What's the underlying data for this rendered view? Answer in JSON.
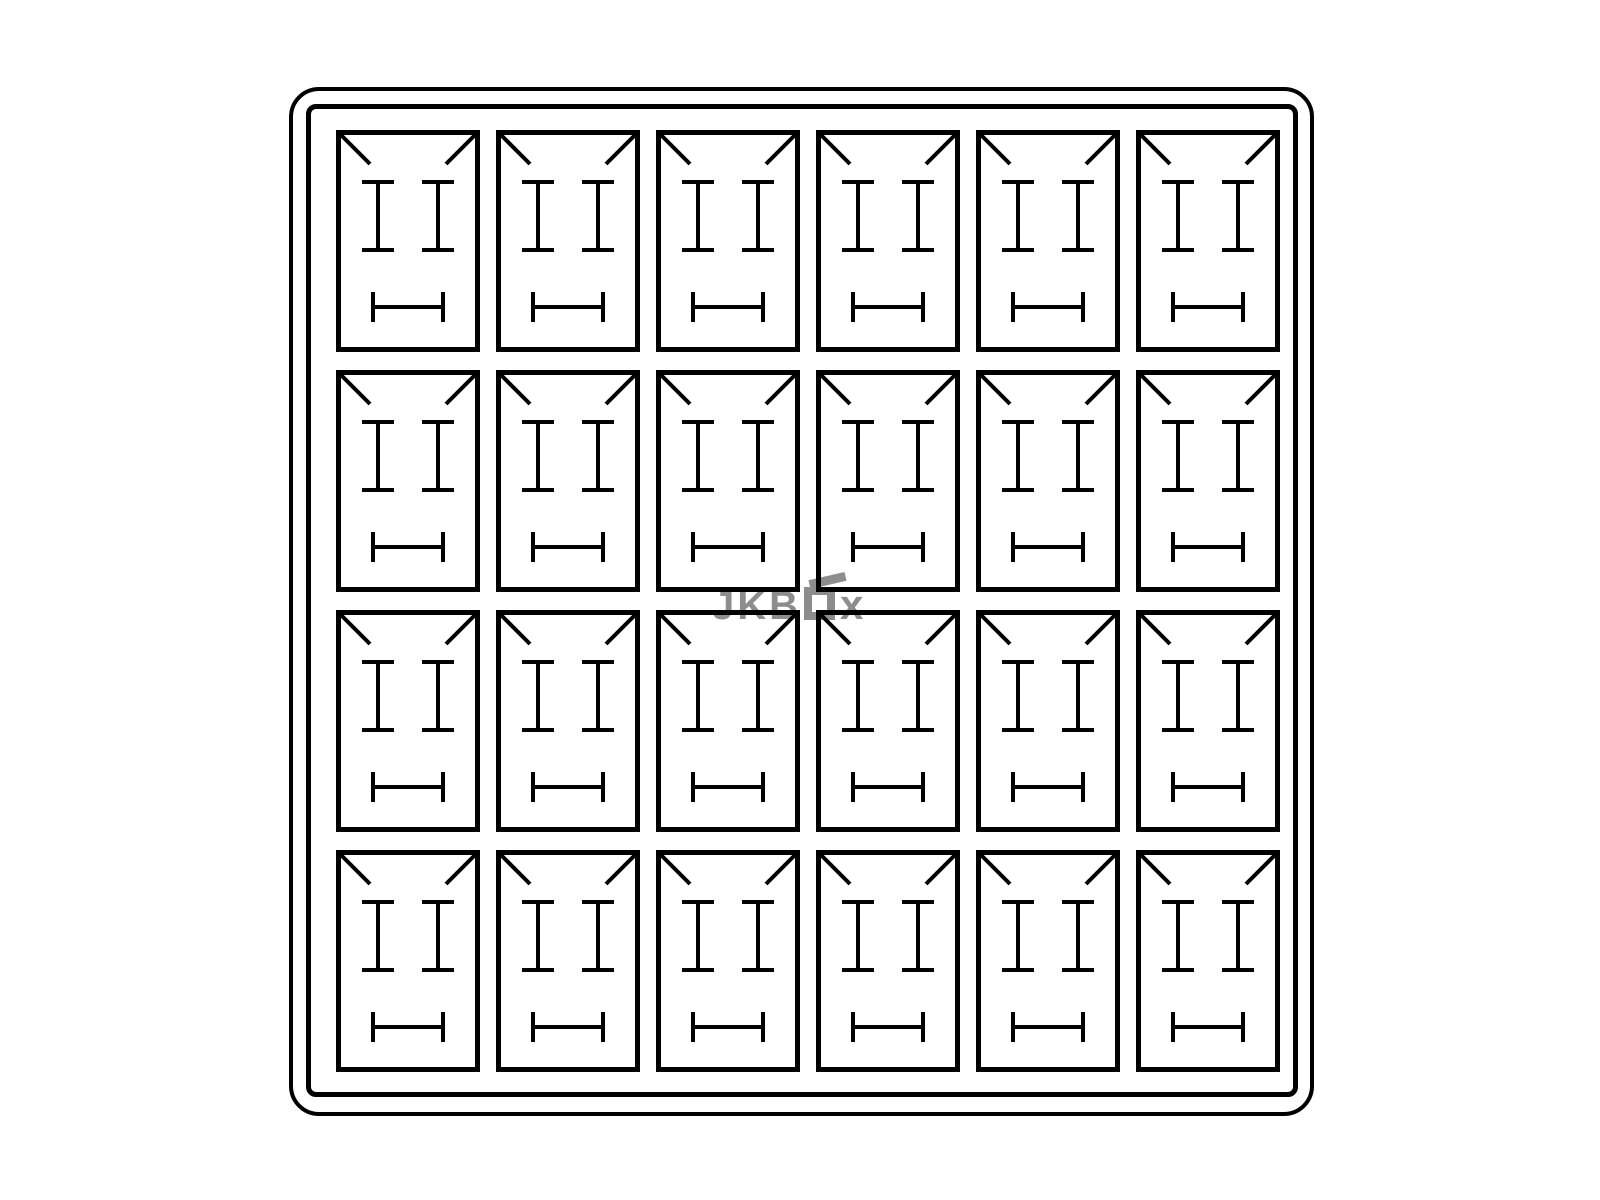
{
  "colors": {
    "background": "#ffffff",
    "line": "#000000",
    "watermark": "#8d8d8d"
  },
  "grid": {
    "rows": 4,
    "columns": 6,
    "slot_count": 24
  },
  "watermark": {
    "brand_prefix": "JKB",
    "brand_suffix": "x",
    "box_glyph": "open-box-icon"
  }
}
